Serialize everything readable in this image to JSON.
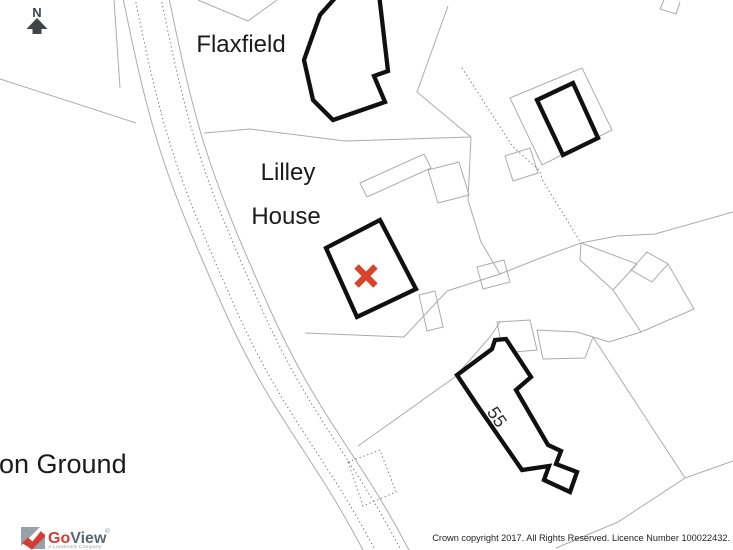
{
  "map": {
    "labels": {
      "flaxfield": "Flaxfield",
      "lilley_line1": "Lilley",
      "lilley_line2": "House",
      "ground": "on Ground",
      "house_number": "55",
      "north": "N"
    }
  },
  "footer": {
    "logo": {
      "go": "Go",
      "view": "View",
      "registered": "®",
      "tagline": "A Landmark Company"
    },
    "copyright": "Crown copyright 2017. All Rights Reserved. Licence Number 100022432."
  },
  "colors": {
    "marker": "#d9432b",
    "boundary": "#a9acae",
    "building_outline": "#101010",
    "logo_red": "#d63a30",
    "logo_slate": "#5b6773"
  }
}
